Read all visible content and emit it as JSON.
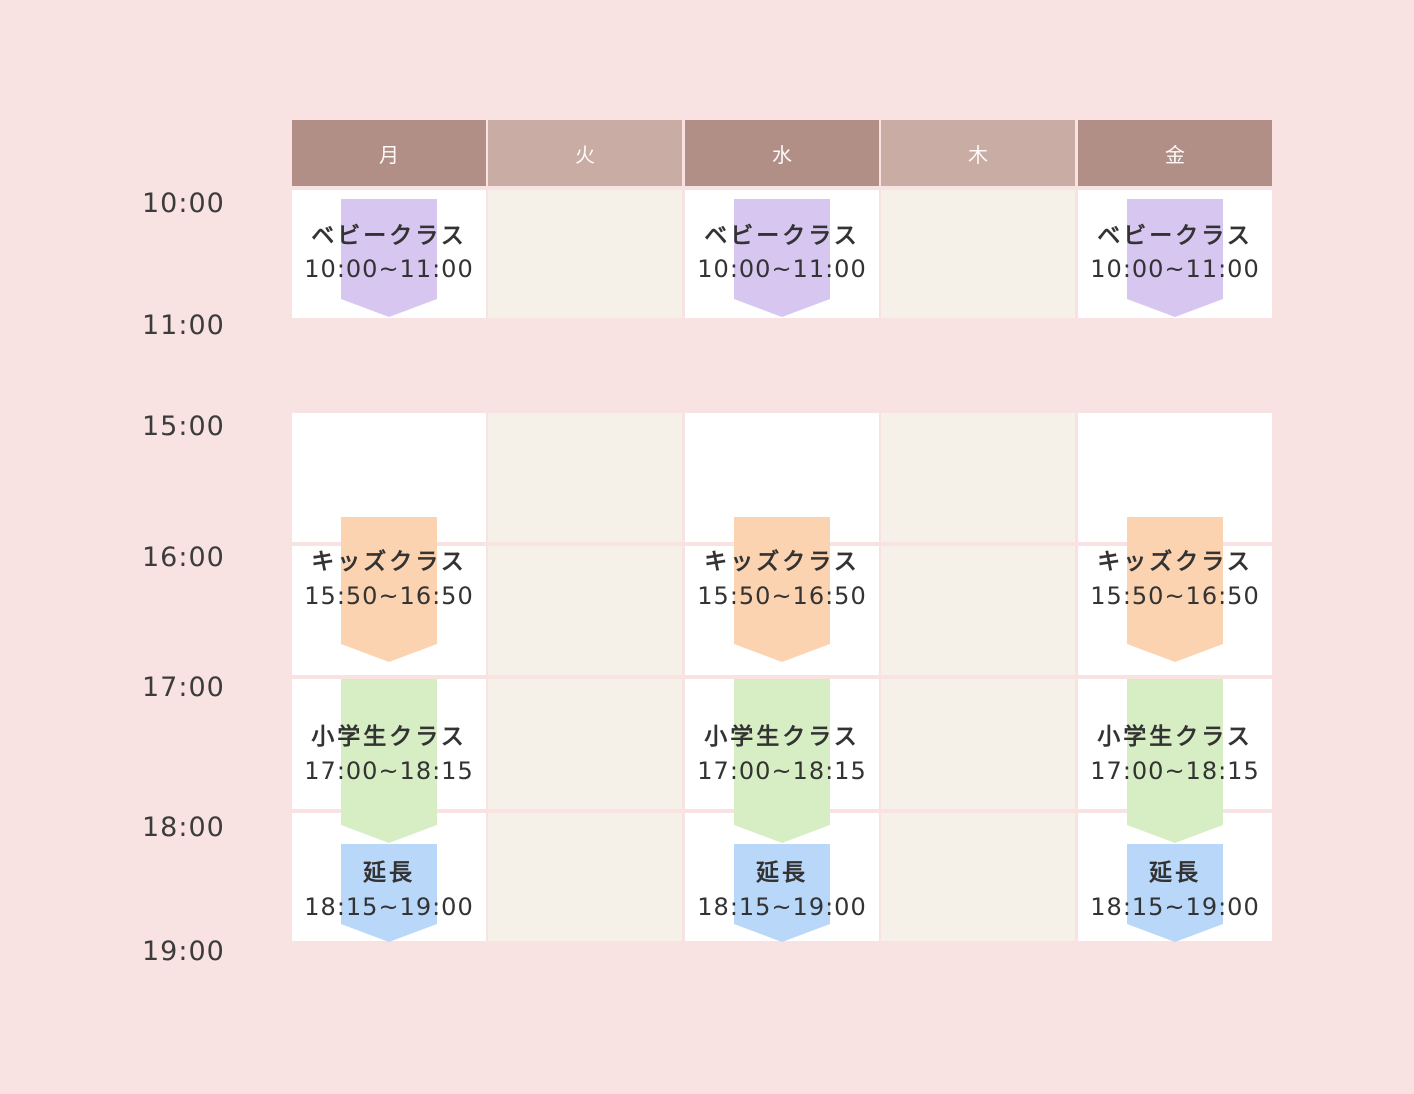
{
  "days": [
    {
      "label": "月",
      "active": true
    },
    {
      "label": "火",
      "active": false
    },
    {
      "label": "水",
      "active": true
    },
    {
      "label": "木",
      "active": false
    },
    {
      "label": "金",
      "active": true
    }
  ],
  "time_labels": [
    "10:00",
    "11:00",
    "15:00",
    "16:00",
    "17:00",
    "18:00",
    "19:00"
  ],
  "classes": {
    "baby": {
      "name": "ベビークラス",
      "time": "10:00~11:00",
      "color": "#d7c6f0",
      "days": [
        "月",
        "水",
        "金"
      ]
    },
    "kids": {
      "name": "キッズクラス",
      "time": "15:50~16:50",
      "color": "#fcd3b0",
      "days": [
        "月",
        "水",
        "金"
      ]
    },
    "elementary": {
      "name": "小学生クラス",
      "time": "17:00~18:15",
      "color": "#d7eec4",
      "days": [
        "月",
        "水",
        "金"
      ]
    },
    "extension": {
      "name": "延長",
      "time": "18:15~19:00",
      "color": "#b9d7f8",
      "days": [
        "月",
        "水",
        "金"
      ]
    }
  },
  "colors": {
    "background": "#f9e2e2",
    "header_active_day": "#b18f86",
    "header_inactive_day": "#c9aca3",
    "cell_active_day": "#ffffff",
    "cell_inactive_day": "#f5f1e9",
    "text": "#333333"
  }
}
